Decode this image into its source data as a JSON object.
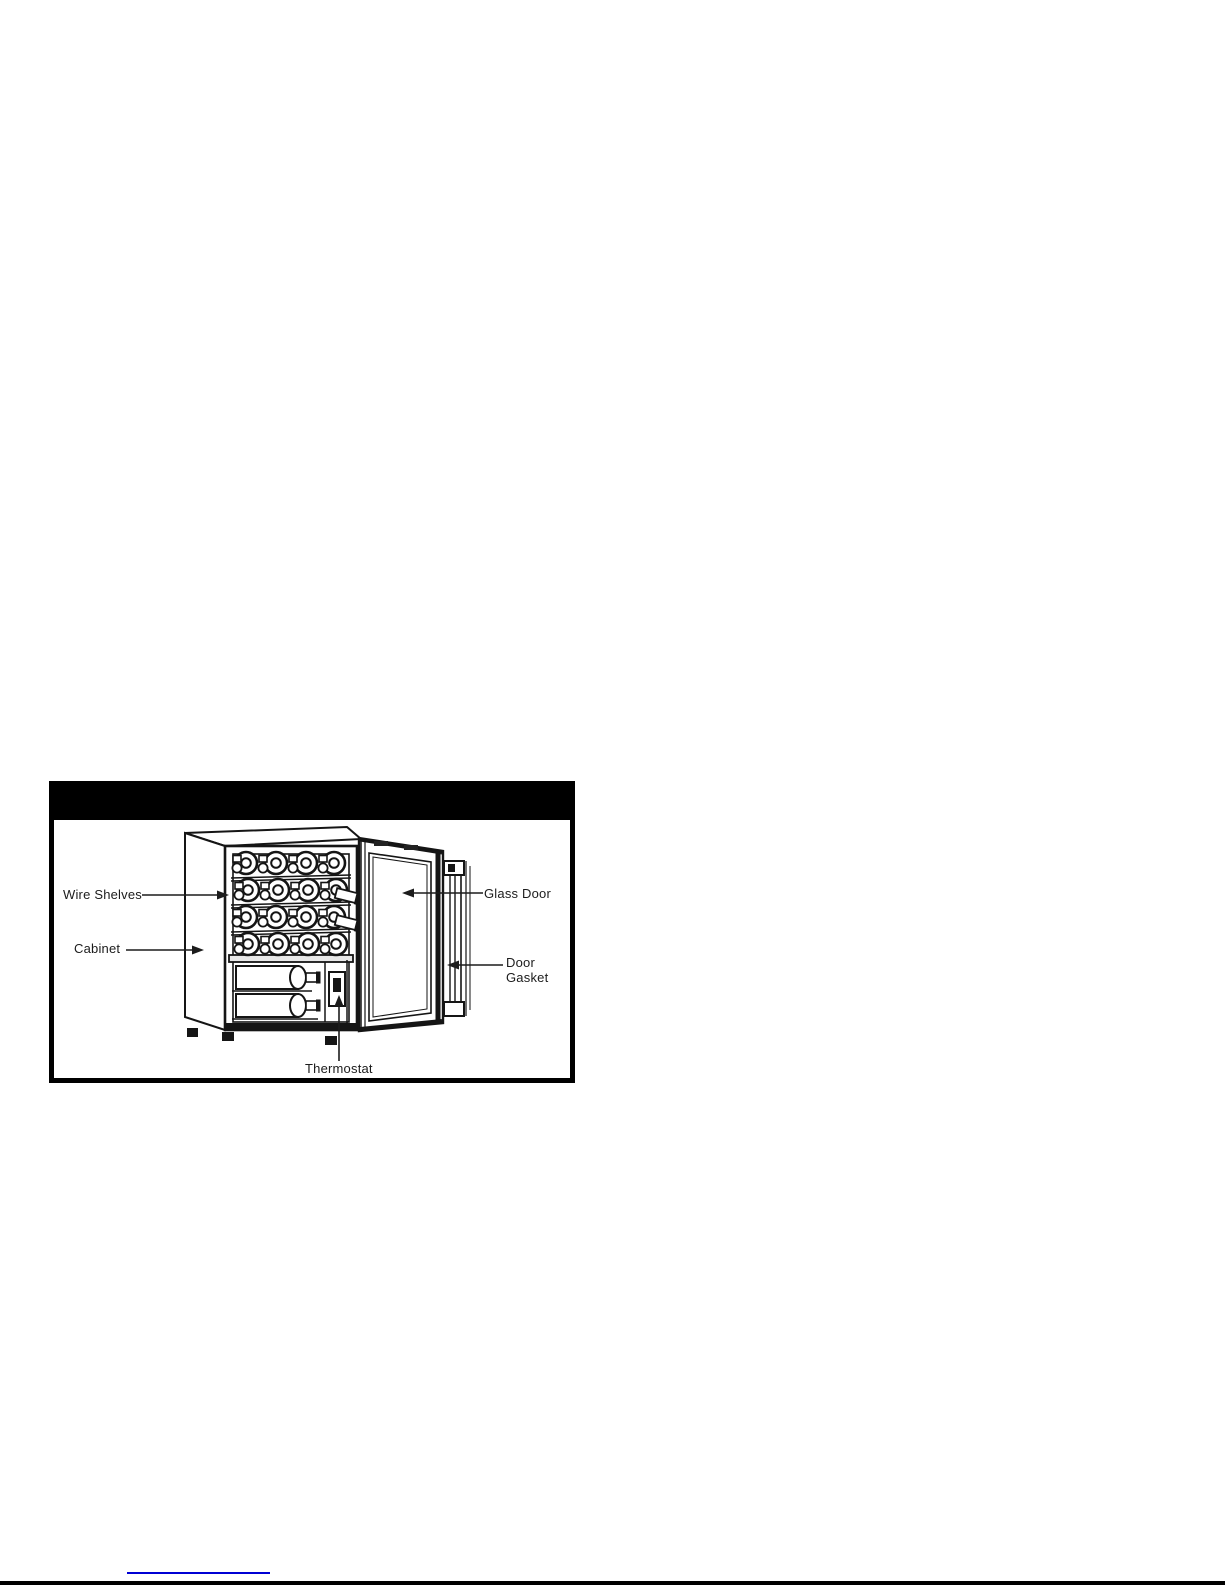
{
  "page": {
    "background_color": "#ffffff",
    "footer_rule_color": "#000000",
    "footer_link_underline_color": "#0000d4"
  },
  "figure": {
    "header_bar_color": "#000000",
    "labels": {
      "wire_shelves": "Wire Shelves",
      "cabinet": "Cabinet",
      "glass_door": "Glass Door",
      "door_gasket_line1": "Door",
      "door_gasket_line2": "Gasket",
      "thermostat": "Thermostat"
    }
  }
}
